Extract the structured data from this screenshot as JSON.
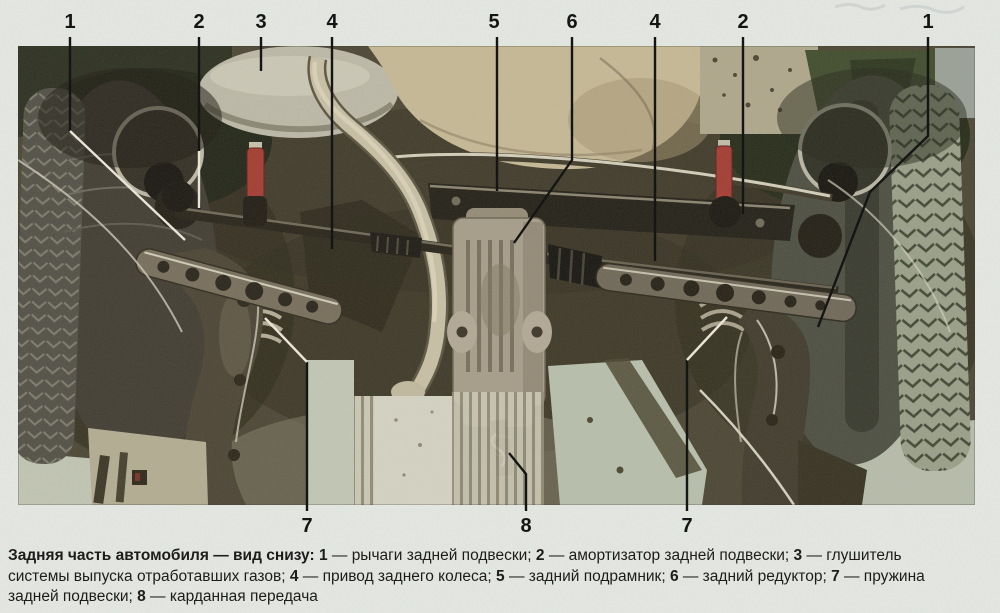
{
  "figure": {
    "description_visible": false,
    "callouts": [
      {
        "id": "top-1-left",
        "label": "1"
      },
      {
        "id": "top-2-left",
        "label": "2"
      },
      {
        "id": "top-3",
        "label": "3"
      },
      {
        "id": "top-4-left",
        "label": "4"
      },
      {
        "id": "top-5",
        "label": "5"
      },
      {
        "id": "top-6",
        "label": "6"
      },
      {
        "id": "top-4-right",
        "label": "4"
      },
      {
        "id": "top-2-right",
        "label": "2"
      },
      {
        "id": "top-1-right",
        "label": "1"
      },
      {
        "id": "bottom-7-left",
        "label": "7"
      },
      {
        "id": "bottom-8",
        "label": "8"
      },
      {
        "id": "bottom-7-right",
        "label": "7"
      }
    ]
  },
  "caption": {
    "lines": [
      [
        {
          "text": "Задняя часть автомобиля — вид снизу: ",
          "bold": true
        },
        {
          "text": "1",
          "bold": true
        },
        {
          "text": " — рычаги задней подвески; ",
          "bold": false
        },
        {
          "text": "2",
          "bold": true
        },
        {
          "text": " — амортизатор задней подвески; ",
          "bold": false
        },
        {
          "text": "3",
          "bold": true
        },
        {
          "text": " — глушитель",
          "bold": false
        }
      ],
      [
        {
          "text": "системы выпуска отработавших газов; ",
          "bold": false
        },
        {
          "text": "4",
          "bold": true
        },
        {
          "text": " — привод заднего колеса; ",
          "bold": false
        },
        {
          "text": "5",
          "bold": true
        },
        {
          "text": " — задний подрамник; ",
          "bold": false
        },
        {
          "text": "6",
          "bold": true
        },
        {
          "text": " — задний редуктор; ",
          "bold": false
        },
        {
          "text": "7",
          "bold": true
        },
        {
          "text": " — пружина",
          "bold": false
        }
      ],
      [
        {
          "text": "задней подвески; ",
          "bold": false
        },
        {
          "text": "8",
          "bold": true
        },
        {
          "text": " — карданная передача",
          "bold": false
        }
      ]
    ]
  },
  "colors": {
    "paper": "#e3e6e0",
    "ink": "#1d1c1a",
    "line": "#151515",
    "accent-red": "#a43a30"
  }
}
